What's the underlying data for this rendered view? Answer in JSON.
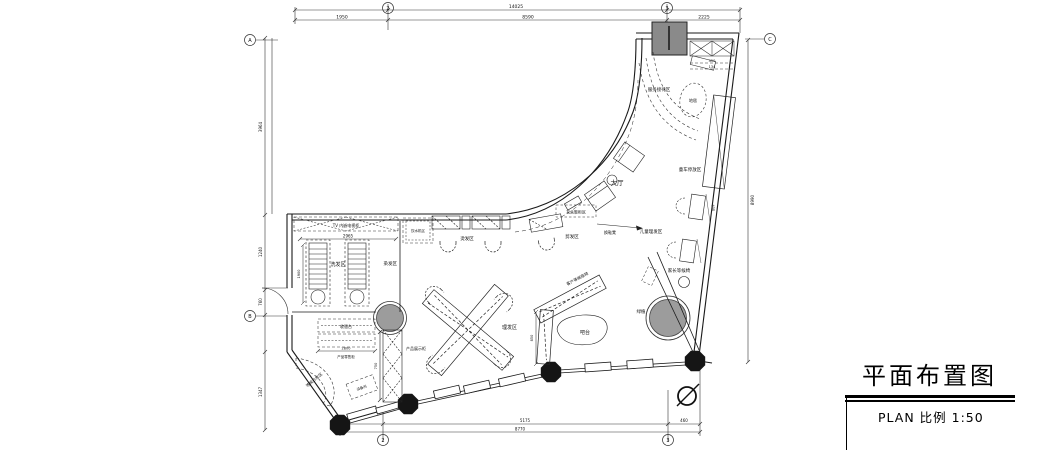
{
  "title_block": {
    "title": "平面布置图",
    "scale_label": "PLAN 比例 1:50"
  },
  "labels": {
    "tv_wall": "TV 内嵌电视柜",
    "water": "饮水机区",
    "washing": "洗发区",
    "perm": "烫发区",
    "cutting": "剪发区",
    "dyeing": "染发区",
    "styling": "理发区",
    "lobby": "大厅",
    "entry_cabinet": "玄关鞋柜区",
    "shoe_bench": "换鞋凳",
    "counter_wait": "客户等候座椅",
    "bar": "吧台",
    "cashier": "收银台",
    "retail": "产品零售柜",
    "showcase": "产品展示柜",
    "sofa": "等候沙发区",
    "equipment": "设备间",
    "reception": "服务接待区",
    "rug": "地毯",
    "kids_cut": "儿童理发区",
    "parent_chair": "家长等候椅",
    "stroller": "童车停放区",
    "plant": "绿植"
  },
  "dims": {
    "top_total": "14025",
    "top_1": "1950",
    "top_2": "8590",
    "top_3": "2225",
    "bottom_1": "5175",
    "bottom_2": "460",
    "bottom_total": "8770",
    "left_1": "3964",
    "left_2": "1240",
    "left_3": "760",
    "left_4": "1347",
    "right_1": "8990",
    "tv_len": "2965",
    "cashier_len": "2800",
    "strip": "750",
    "bed": "1900",
    "hatch_1": "450",
    "hatch_2": "134",
    "bar_len": "850",
    "kid_seat": "600"
  },
  "axis": {
    "g2": "2",
    "g3": "3",
    "gA": "A",
    "gB": "B",
    "gC": "C"
  }
}
